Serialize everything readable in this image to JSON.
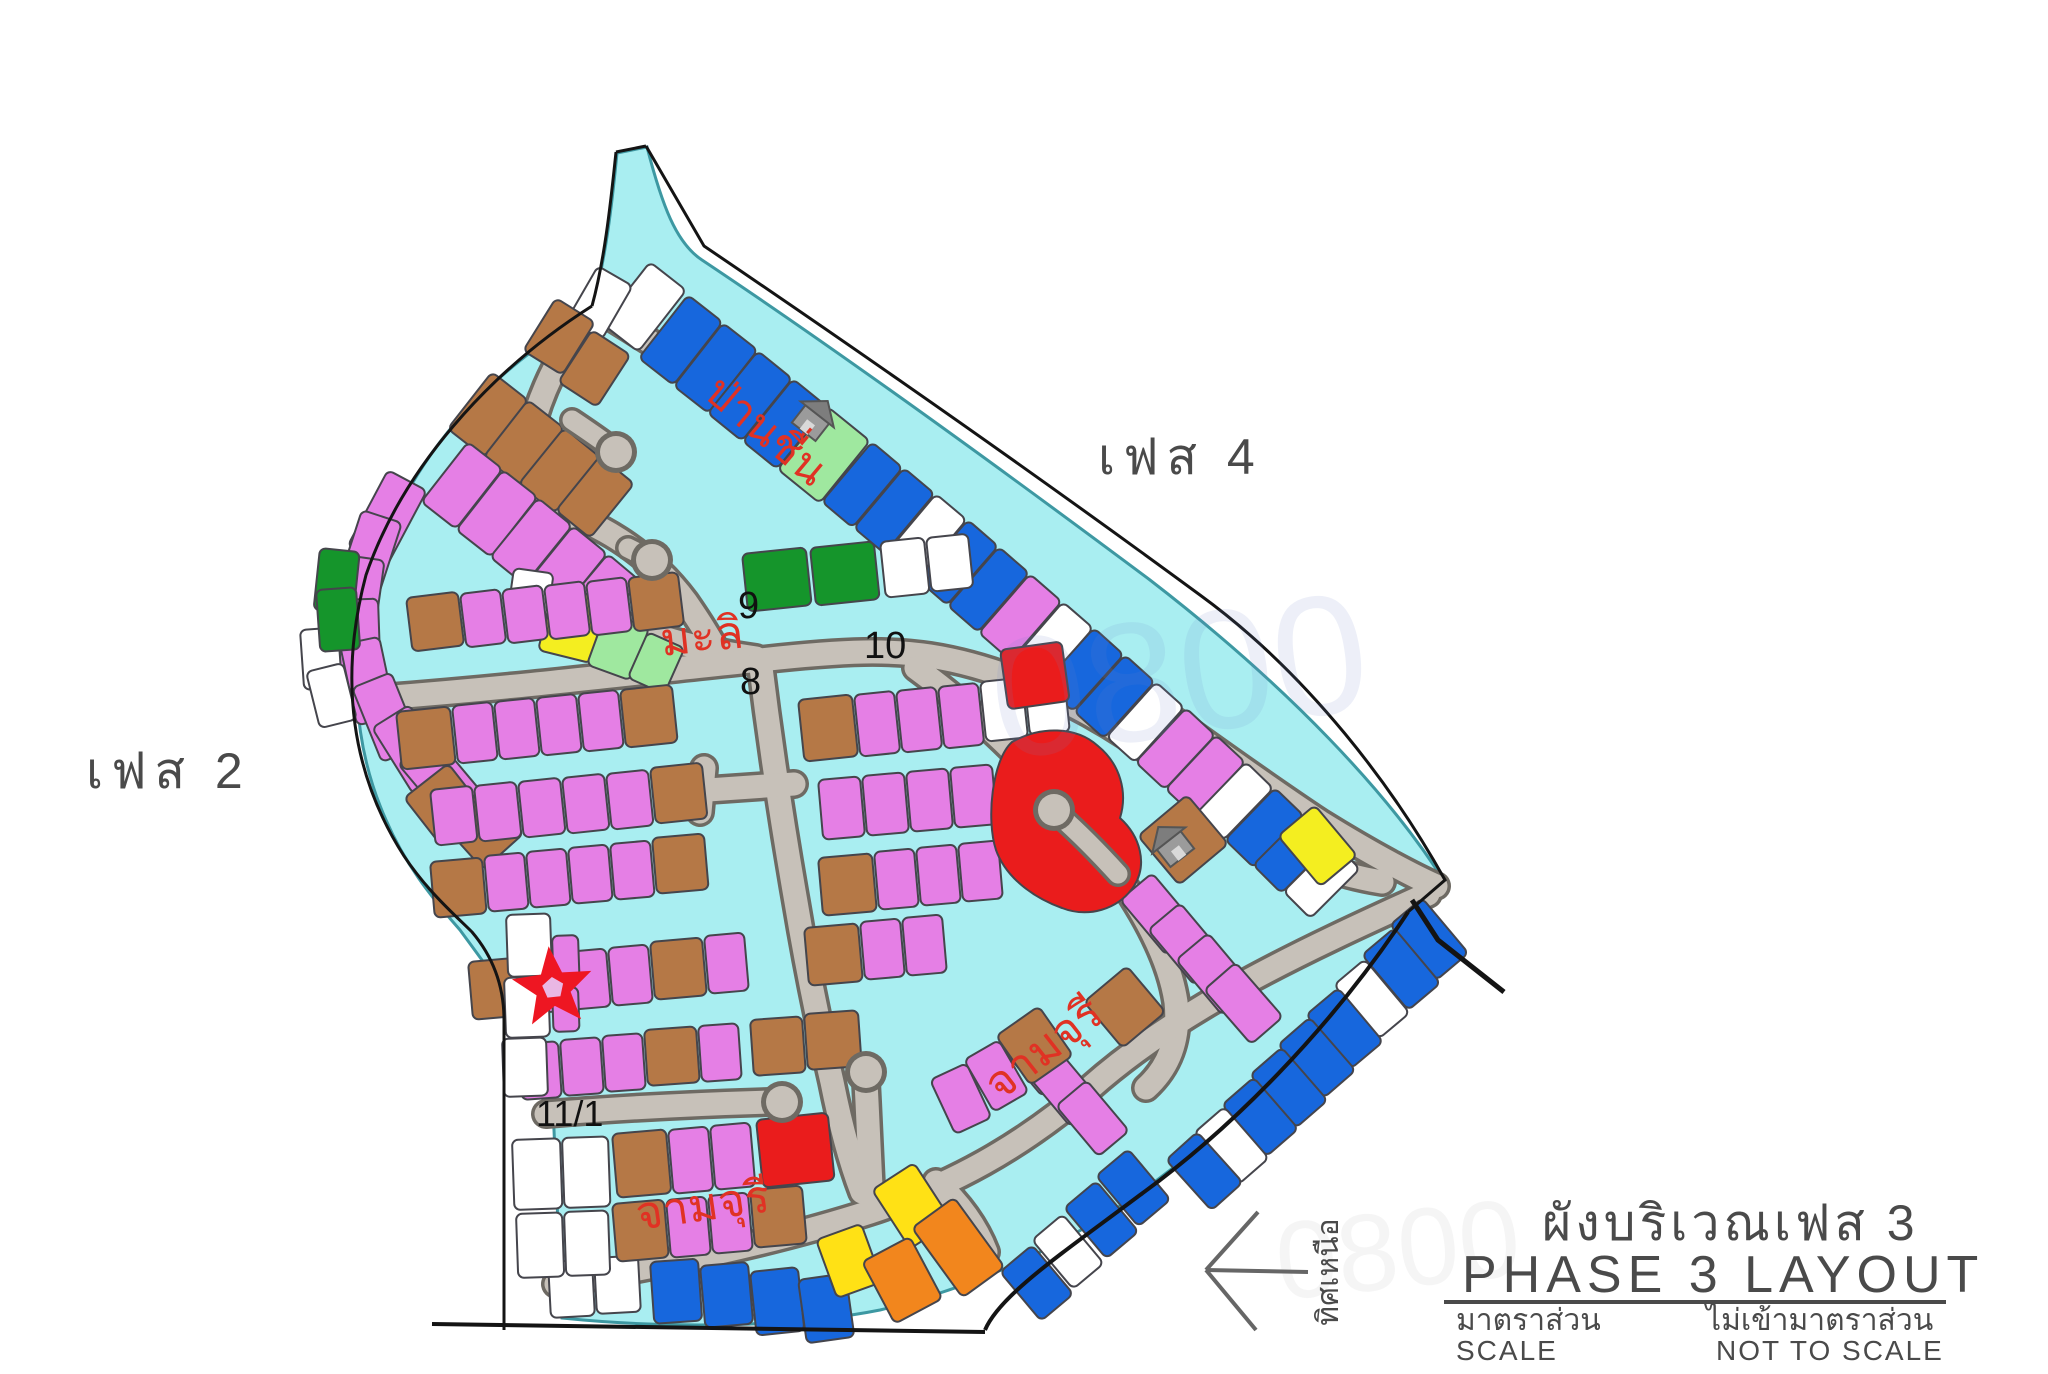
{
  "palette": {
    "cyan": "#a9eef1",
    "cyanEdge": "#3d98a2",
    "road": "#c7c1b9",
    "roadEdge": "#6e6a63",
    "violet": "#e57fe5",
    "brown": "#b57846",
    "blue": "#1767dd",
    "greenD": "#15952b",
    "greenL": "#9fe89f",
    "yellow": "#f4ee20",
    "yellowB": "#ffe115",
    "orange": "#f2861d",
    "red": "#ea1c1c",
    "white": "#ffffff",
    "outline": "#45454c",
    "boundary": "#141414",
    "labelRed": "#e03224",
    "text": "#4a4a4a",
    "watermark": "#6f86c9",
    "starRed": "#ee1622",
    "starCenter": "#e9b7e4",
    "houseGray": "#9b9b9b"
  },
  "labels": {
    "phase4": "เฟส 4",
    "phase2": "เฟส 2",
    "road_banchuen": "ป่านชื่น",
    "road_mali": "มะลิ",
    "road_jamjuree_bottom": "จามจุรี",
    "road_jamjuree_right": "จามจุรี",
    "junction_9": "9",
    "junction_10": "10",
    "junction_8": "8",
    "road_11_1": "11/1",
    "watermark": "0800"
  },
  "title_block": {
    "title_th": "ผังบริเวณเฟส 3",
    "title_en": "PHASE 3 LAYOUT",
    "scale_th": "มาตราส่วน",
    "scale_en": "SCALE",
    "not_to_scale_th": "ไม่เข้ามาตราส่วน",
    "not_to_scale_en": "NOT TO SCALE"
  },
  "compass": {
    "label_th": "ทิศเหนือ"
  }
}
